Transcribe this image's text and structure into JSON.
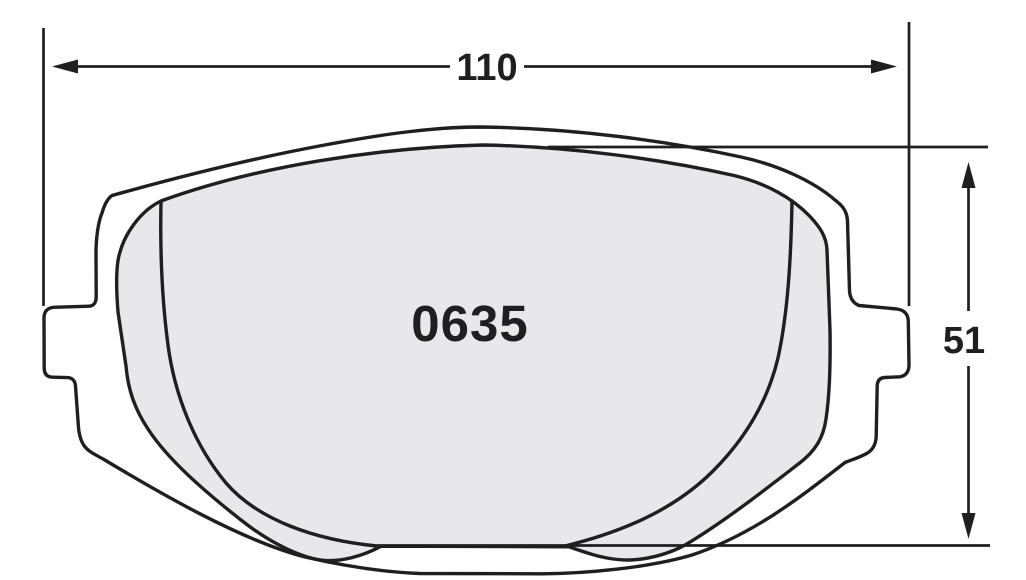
{
  "drawing": {
    "part_number": "0635",
    "dimensions": {
      "width_label": "110",
      "height_label": "51"
    },
    "icons": {
      "arrowheads": [
        "arrow-left-icon",
        "arrow-right-icon",
        "arrow-up-icon",
        "arrow-down-icon"
      ]
    },
    "colors": {
      "line": "#1f1f21",
      "friction_fill": "#e8e8ea",
      "backing_fill": "#ffffff",
      "background": "#ffffff"
    }
  }
}
